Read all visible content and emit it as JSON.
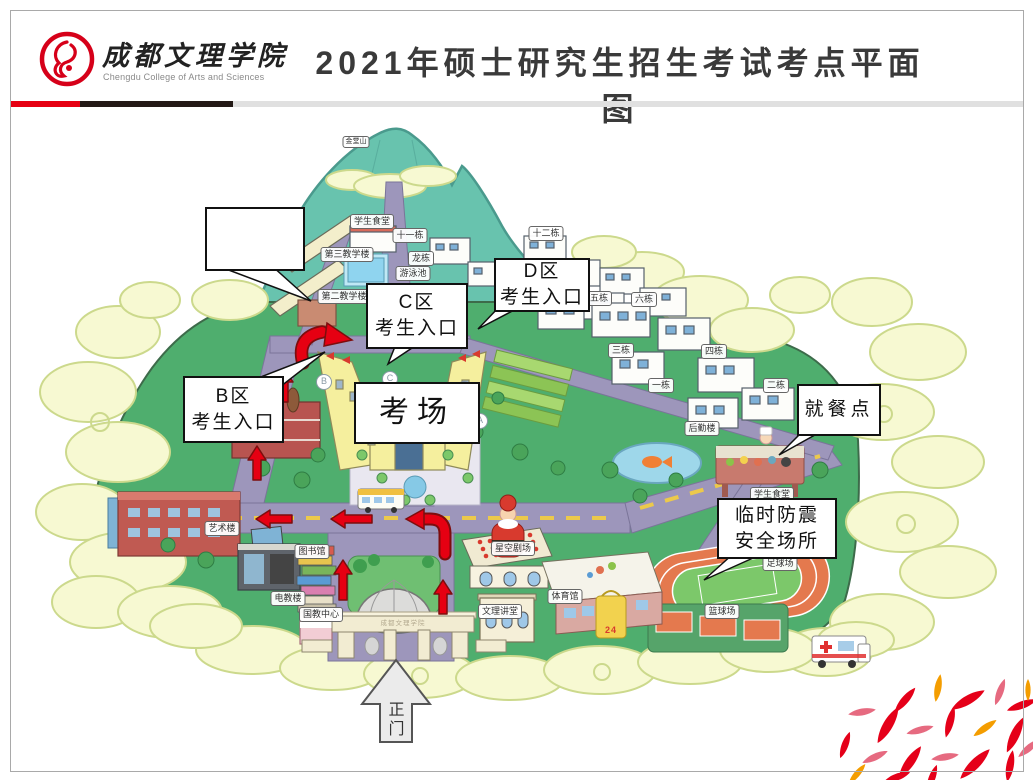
{
  "header": {
    "title": "2021年硕士研究生招生考试考点平面图",
    "logo": {
      "name_cn": "成都文理学院",
      "name_en": "Chengdu College of Arts and Sciences"
    }
  },
  "map": {
    "callouts": {
      "note_empty": "",
      "d_line1": "D区",
      "d_line2": "考生入口",
      "c_line1": "C区",
      "c_line2": "考生入口",
      "b_line1": "B区",
      "b_line2": "考生入口",
      "exam_hall": "考场",
      "dining": "就餐点",
      "shelter_line1": "临时防震",
      "shelter_line2": "安全场所",
      "gate_line1": "正",
      "gate_line2": "门"
    },
    "wings": {
      "a": "A",
      "b": "B",
      "c": "C",
      "d": "D"
    },
    "labels": {
      "jintang_hill": "金堂山",
      "canteen_top": "学生食堂",
      "bldg_11": "十一栋",
      "bldg_12": "十二栋",
      "teach_3": "第三教学楼",
      "bldg_long": "龙栋",
      "pool": "游泳池",
      "teach_2": "第二教学楼",
      "bldg_5": "五栋",
      "bldg_6": "六栋",
      "bldg_3": "三栋",
      "bldg_4": "四栋",
      "bldg_1": "一栋",
      "bldg_2": "二栋",
      "logistics": "后勤楼",
      "canteen_bottom": "学生食堂",
      "art_bldg": "艺术楼",
      "library": "图书馆",
      "etech_bldg": "电教楼",
      "intl_center": "国教中心",
      "star_theater": "星空剧场",
      "lecture_hall": "文理讲堂",
      "gym": "体育馆",
      "football_field": "足球场",
      "basketball_court": "篮球场",
      "bag_24": "24",
      "gate_sign": "成都文理学院"
    }
  },
  "colors": {
    "accent_red": "#e60012",
    "bar_black": "#231916",
    "bar_gray": "#e0e0e0",
    "route_arrow": "#e60012",
    "petal_red": "#e50019",
    "petal_rose": "#e66a80",
    "petal_orange": "#f49d00"
  }
}
